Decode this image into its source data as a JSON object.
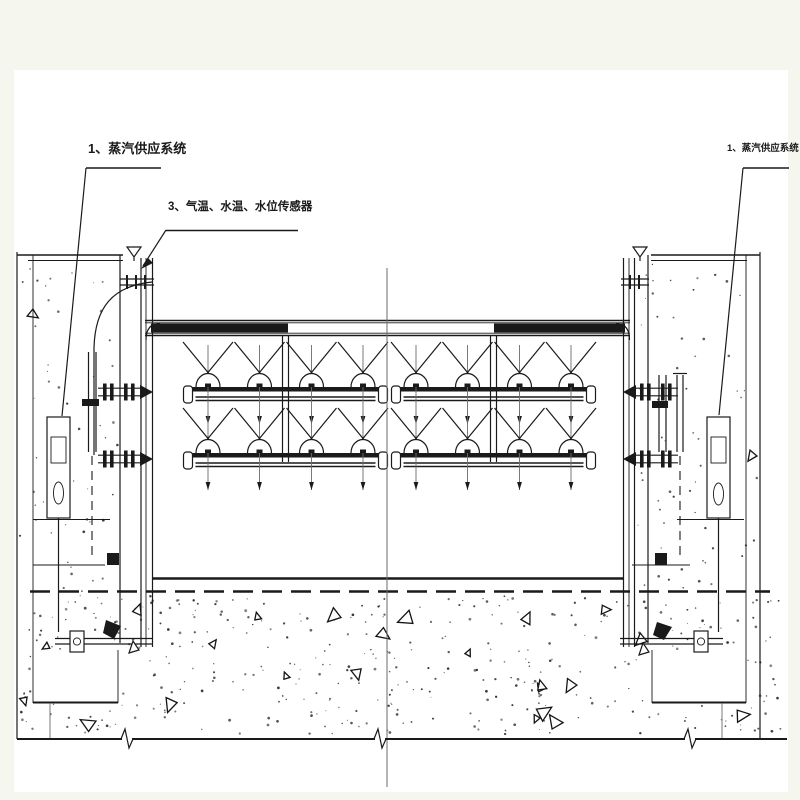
{
  "page": {
    "background": "#f5f7ee",
    "sheet_color": "#ffffff",
    "line_color": "#1a1a1a",
    "description_labels_count": "3"
  },
  "labels": {
    "steam_system_left": "1、蒸汽供应系统",
    "sensors": "3、气温、水温、水位传感器",
    "steam_system_right": "1、蒸汽供应系统"
  },
  "symbols": {
    "water_level_left": "water-level-triangle",
    "water_level_right": "water-level-triangle",
    "leader_arrow": "solid-arrowhead",
    "concrete_texture": "stipple-dots-and-aggregate-triangles"
  }
}
